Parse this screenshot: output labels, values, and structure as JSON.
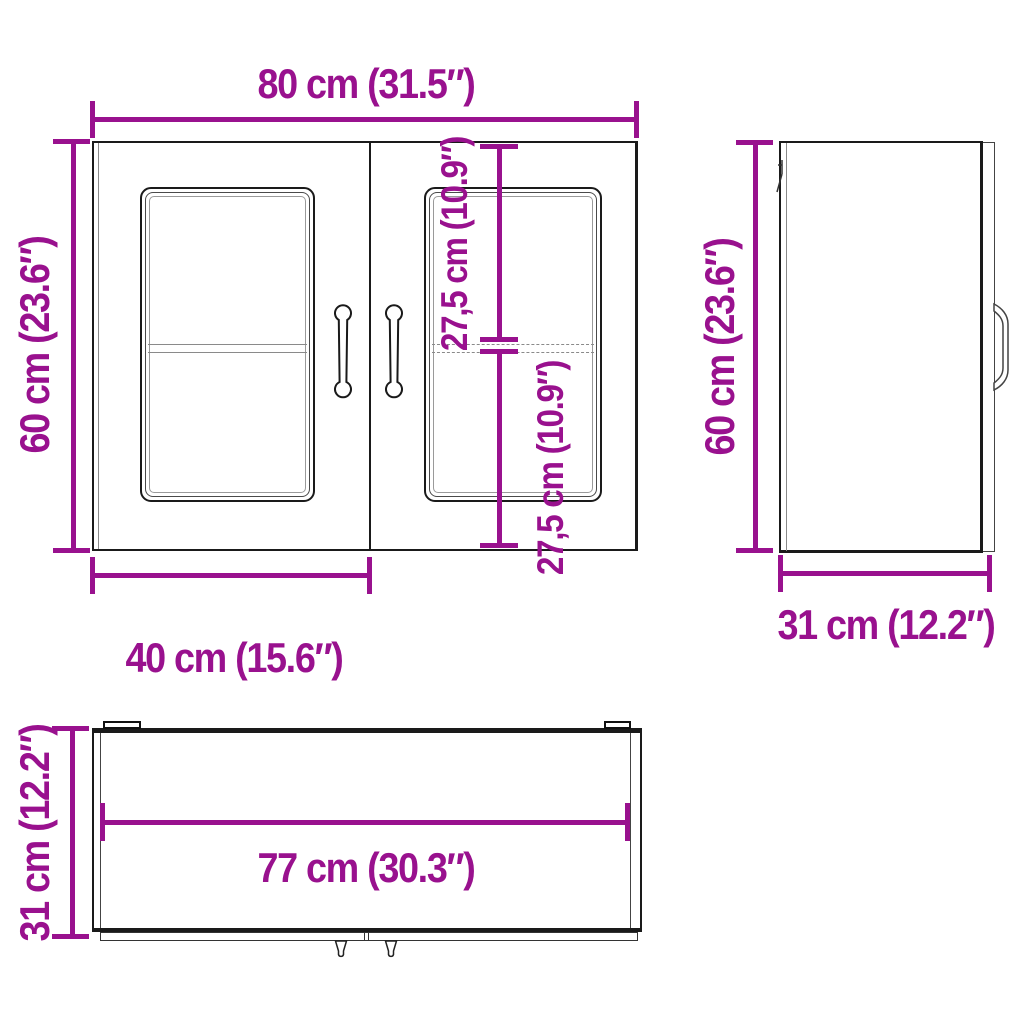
{
  "diagram": {
    "accent_color": "#99118E",
    "line_color": "#1a1a1a",
    "views": {
      "front": {
        "width": "80 cm (31.5″)",
        "height": "60 cm (23.6″)",
        "door_width": "40 cm (15.6″)",
        "upper_compartment": "27,5 cm (10.9″)",
        "lower_compartment": "27,5 cm (10.9″)"
      },
      "side": {
        "height": "60 cm (23.6″)",
        "depth": "31 cm (12.2″)"
      },
      "top": {
        "inner_width": "77 cm (30.3″)",
        "depth": "31 cm (12.2″)"
      }
    }
  }
}
